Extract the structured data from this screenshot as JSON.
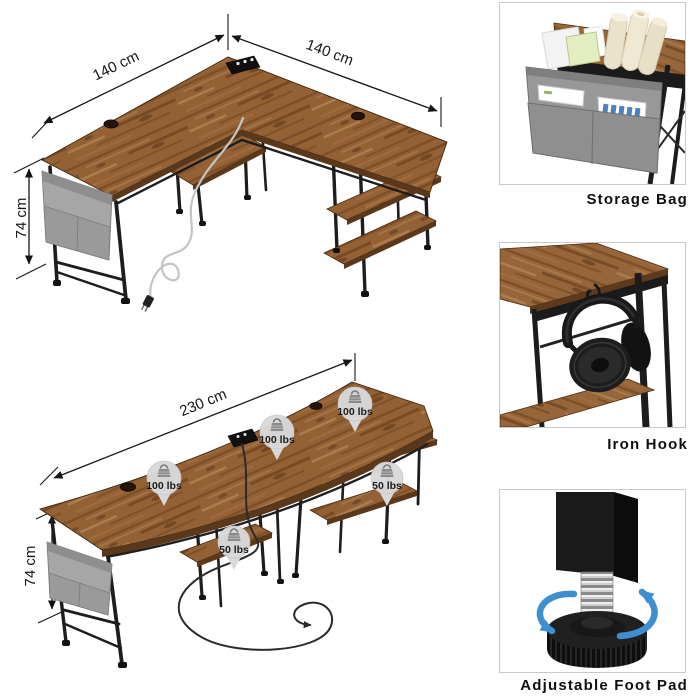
{
  "top_diagram": {
    "name": "l-shaped-desk-with-dimensions",
    "left_width_label": "140 cm",
    "right_width_label": "140 cm",
    "height_label": "74 cm"
  },
  "bottom_diagram": {
    "name": "long-desk-with-dimensions",
    "width_label": "230 cm",
    "height_label": "74 cm",
    "badges": [
      {
        "label": "100 lbs"
      },
      {
        "label": "100 lbs"
      },
      {
        "label": "100 lbs"
      },
      {
        "label": "50 lbs"
      },
      {
        "label": "50 lbs"
      }
    ]
  },
  "feature_panels": [
    {
      "label": "Storage Bag",
      "icon": "storage-bag-icon"
    },
    {
      "label": "Iron Hook",
      "icon": "headphones-on-hook-icon"
    },
    {
      "label": "Adjustable Foot Pad",
      "icon": "adjustable-foot-pad-icon"
    }
  ],
  "colors": {
    "background": "#ffffff",
    "wood": "#96653a",
    "wood_dark": "#5a381c",
    "frame_black": "#1c1c1c",
    "bag_gray": "#a3a3a3",
    "badge_gray": "#d9d9d9",
    "rotation_arrow_blue": "#3e8ed0",
    "dimension_line": "#161616",
    "panel_border": "#c9c9c9"
  }
}
